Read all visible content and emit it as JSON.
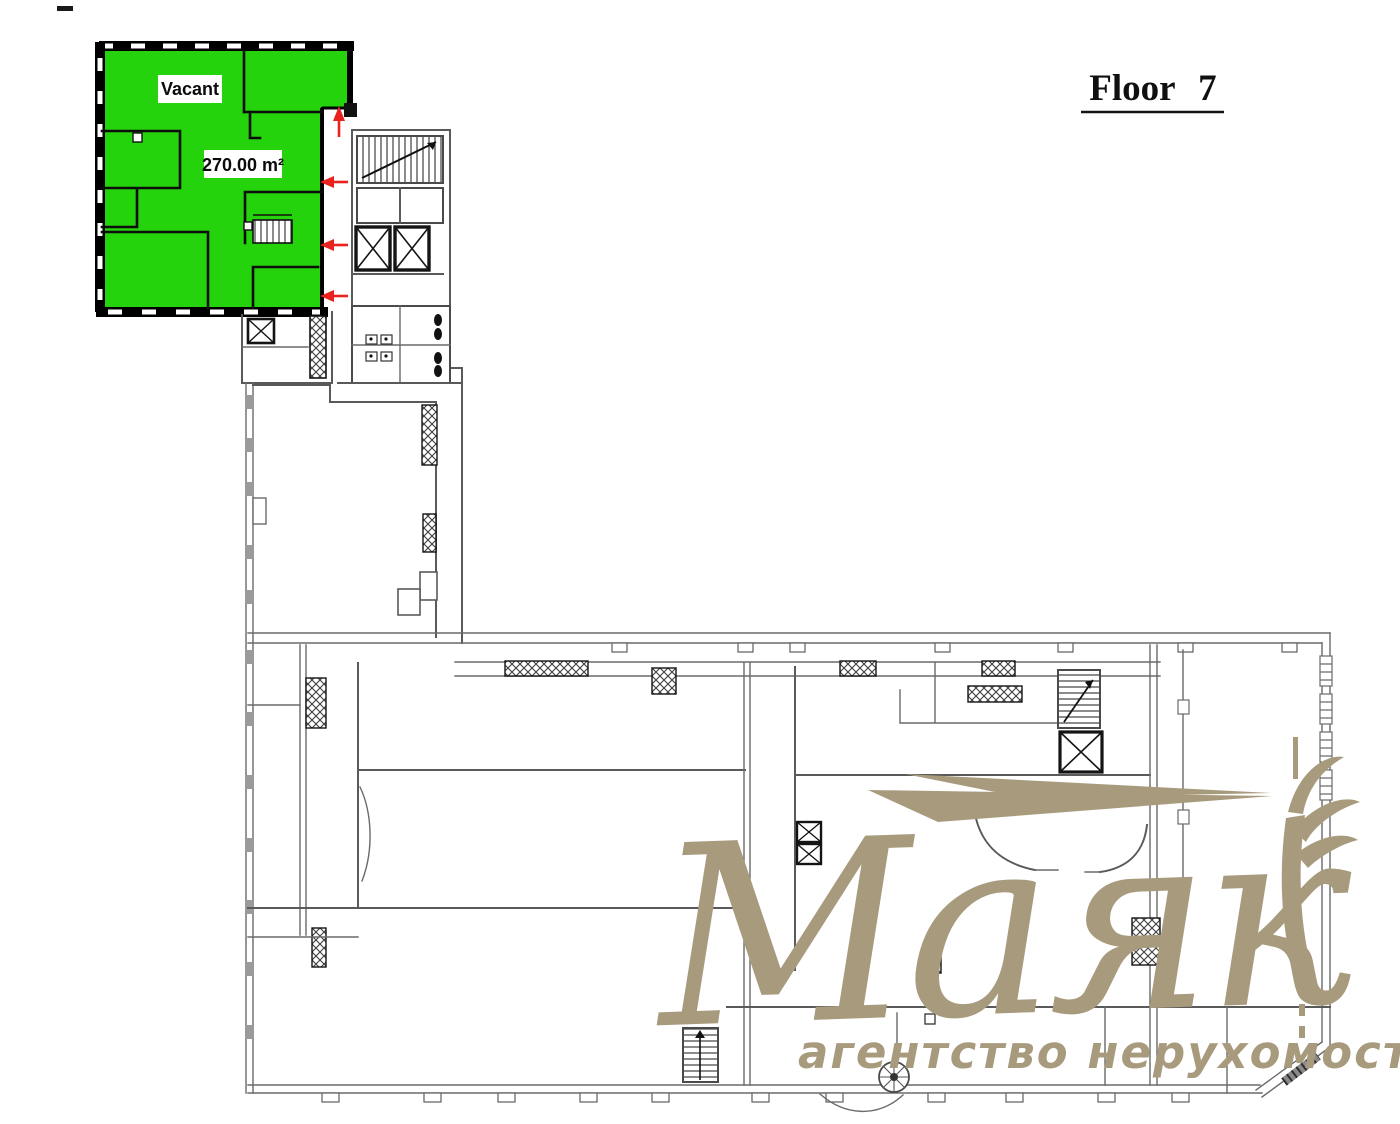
{
  "header": {
    "title": "Floor 7"
  },
  "plan": {
    "vacant_unit": {
      "label": "Vacant",
      "area": "270.00 m²",
      "fill": "#24d30b"
    },
    "entry_arrows": {
      "color": "#e8221f",
      "items": [
        {
          "direction": "up"
        },
        {
          "direction": "left"
        },
        {
          "direction": "left"
        },
        {
          "direction": "left"
        }
      ]
    },
    "wall_color": "#5a5a5a",
    "heavy_wall_color": "#141414",
    "features": [
      "staircase",
      "elevators",
      "toilets",
      "spiral-staircase",
      "secondary-staircase"
    ]
  },
  "watermark": {
    "brand": "Маяк",
    "tagline": "агентство нерухомості",
    "color": "#a89b7d"
  }
}
